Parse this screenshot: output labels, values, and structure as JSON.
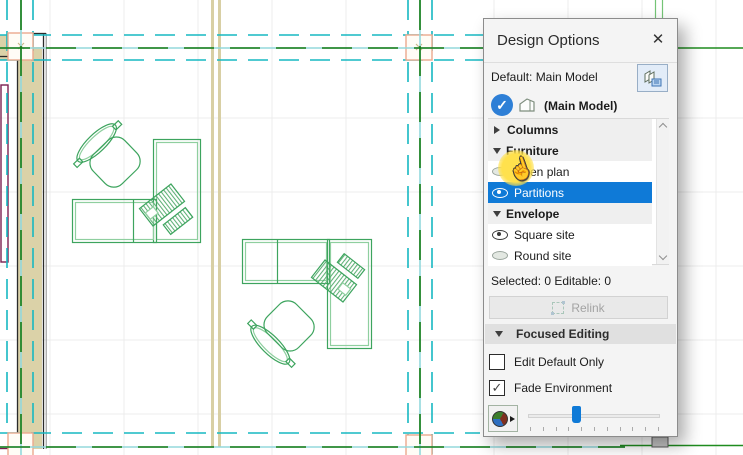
{
  "panel": {
    "title": "Design Options",
    "default_row": {
      "label": "Default: Main Model"
    },
    "active_model": {
      "label": "(Main Model)"
    },
    "tree": {
      "items": [
        {
          "type": "group",
          "label": "Columns",
          "expanded": false
        },
        {
          "type": "group",
          "label": "Furniture",
          "expanded": true
        },
        {
          "type": "option",
          "label": "Open plan",
          "eye": "closed",
          "selected": false,
          "highlighted_by_cursor": true
        },
        {
          "type": "option",
          "label": "Partitions",
          "eye": "open",
          "selected": true
        },
        {
          "type": "group",
          "label": "Envelope",
          "expanded": true
        },
        {
          "type": "option",
          "label": "Square site",
          "eye": "open",
          "selected": false
        },
        {
          "type": "option",
          "label": "Round site",
          "eye": "closed",
          "selected": false
        }
      ]
    },
    "status": {
      "label": "Selected: 0 Editable: 0"
    },
    "relink_button": {
      "label": "Relink",
      "enabled": false
    },
    "focused_editing": {
      "label": "Focused Editing",
      "expanded": true
    },
    "checkboxes": [
      {
        "label": "Edit Default Only",
        "checked": false
      },
      {
        "label": "Fade Environment",
        "checked": true
      }
    ],
    "fade_slider": {
      "value_percent": 36
    }
  },
  "glyphs": {
    "close": "✕",
    "check": "✓",
    "cursor_hand": "☝"
  },
  "colors": {
    "selection_blue": "#0f7ad7",
    "check_circle_blue": "#2e7fd6",
    "cursor_highlight_yellow": "#ffe14d",
    "grid_teal_dashed": "#17b8c2",
    "axis_cyan_solid": "#93d8dc",
    "axis_green_dash": "#127a12",
    "site_green": "#2a9428",
    "furniture_green": "#3da45e",
    "wall_tan": "#dbd2a8",
    "grid_marker_pink": "#eba98e",
    "wall_maroon": "#7a2050",
    "panel_bg": "#f4f4f4"
  }
}
